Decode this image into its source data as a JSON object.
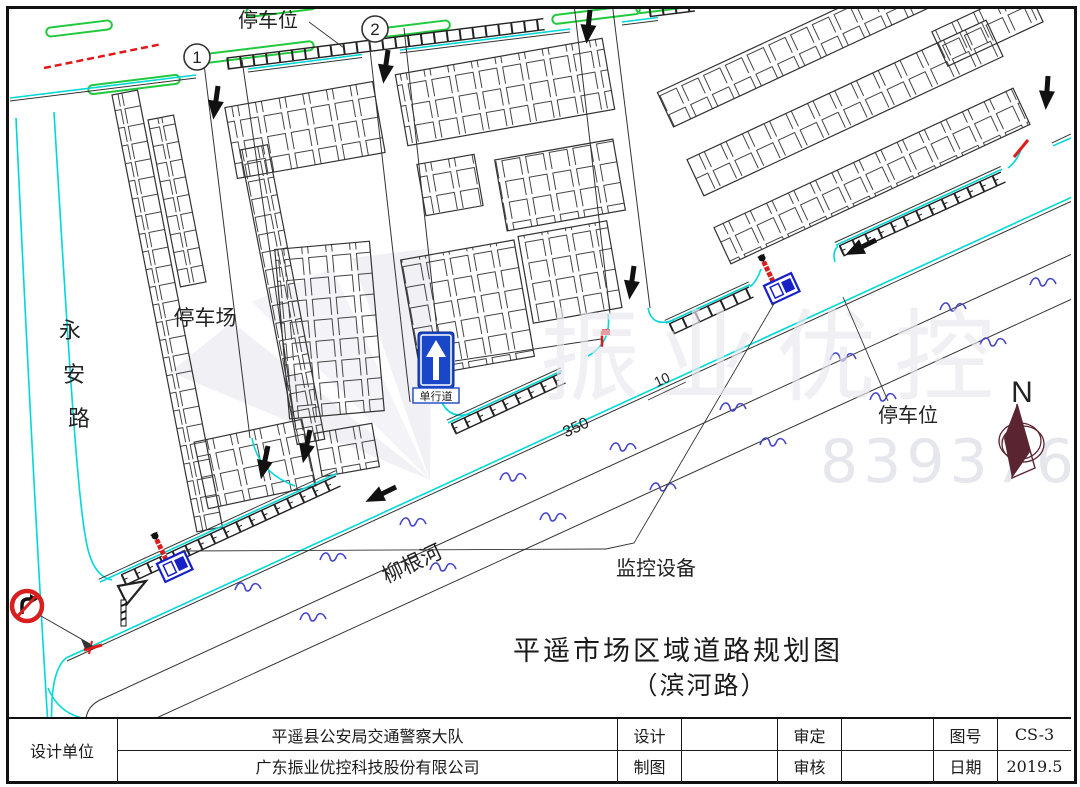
{
  "drawing": {
    "title": "平遥市场区域道路规划图",
    "subtitle": "（滨河路）"
  },
  "labels": {
    "parking_spot_top": "停车位",
    "parking_spot_right": "停车位",
    "parking_lot": "停车场",
    "yongan_road": [
      "永",
      "安",
      "路"
    ],
    "liugen_river": "柳根河",
    "monitor_device": "监控设备",
    "one_way_sign": "单行道"
  },
  "markers": {
    "num1": "1",
    "num2": "2"
  },
  "dimensions": {
    "road_length": "350",
    "road_width": "10"
  },
  "compass": {
    "north": "N"
  },
  "watermark": {
    "brand": "振业优控",
    "number": "839376"
  },
  "title_block": {
    "design_unit_label": "设计单位",
    "design_unit_1": "平遥县公安局交通警察大队",
    "design_unit_2": "广东振业优控科技股份有限公司",
    "design_label": "设计",
    "draft_label": "制图",
    "approve_label": "审定",
    "review_label": "审核",
    "drawing_no_label": "图号",
    "drawing_no": "CS-3",
    "date_label": "日期",
    "date": "2019.5"
  },
  "colors": {
    "road_edge_cyan": "#00d8d8",
    "line_black": "#333333",
    "parking_green": "#21c93e",
    "warning_red": "#e01818",
    "water_blue": "#4646cc",
    "device_blue": "#1820c8",
    "sign_blue": "#1a46c8"
  }
}
